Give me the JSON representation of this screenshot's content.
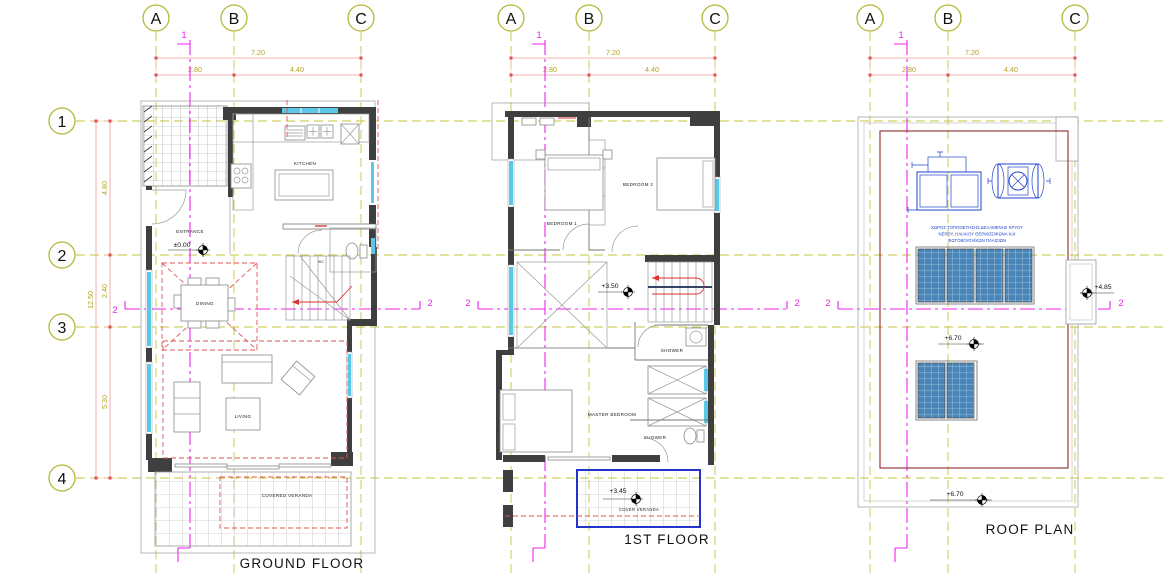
{
  "grid": {
    "columns": [
      "A",
      "B",
      "C"
    ],
    "rows": [
      "1",
      "2",
      "3",
      "4"
    ]
  },
  "dimensions": {
    "top_total": "7.20",
    "top_left": "2.80",
    "top_right": "4.40",
    "left_total": "12.50",
    "left_seg1": "4.80",
    "left_seg2": "2.40",
    "left_seg3": "5.30"
  },
  "sections": {
    "vertical": "1",
    "horizontal": "2"
  },
  "ground_floor": {
    "title": "GROUND FLOOR",
    "rooms": {
      "kitchen": "KITCHEN",
      "entrance": "ENTRANCE",
      "wc": "WC",
      "dining": "DINING",
      "living": "LIVING",
      "veranda": "COVERED VERANDA"
    },
    "levels": {
      "entrance": "±0.00"
    }
  },
  "first_floor": {
    "title": "1ST FLOOR",
    "rooms": {
      "bedroom1": "BEDROOM 1",
      "bedroom2": "BEDROOM 2",
      "shower_upper": "SHOWER",
      "master_bedroom": "MASTER BEDROOM",
      "shower_lower": "SHOWER",
      "veranda": "COVER VERANDA"
    },
    "levels": {
      "stair_landing": "+3.50",
      "veranda": "+3.45"
    }
  },
  "roof_plan": {
    "title": "ROOF PLAN",
    "note": {
      "line1": "ΧΩΡΟΣ ΤΟΠΟΘΕΤΗΣΗΣ ΔΕΞΑΜΕΝΗΣ ΚΡΥΟΥ",
      "line2": "ΝΕΡΟΥ, ΗΛΙΑΚΟΥ ΘΕΡΜΟΣΙΦΩΝΑ ΚΑΙ",
      "line3": "ΦΩΤΟΒΟΛΤΑΪΚΩΝ ΠΛΑΙΣΙΩΝ"
    },
    "levels": {
      "stair_bulkhead": "+4.85",
      "main_roof": "+6.70",
      "lower_roof": "+6.70"
    }
  },
  "colors": {
    "grid_line": "#c3c63e",
    "dimension_line": "#ef9a9a",
    "dimension_text": "#b5a021",
    "section_line": "#ee22ee",
    "wall": "#3f3f3f",
    "red_dashed": "#e05555",
    "blue": "#2244cc",
    "cyan_window": "#5bc8e8",
    "solar_panel": "#4a86b8",
    "maroon": "#8b2a2a"
  }
}
